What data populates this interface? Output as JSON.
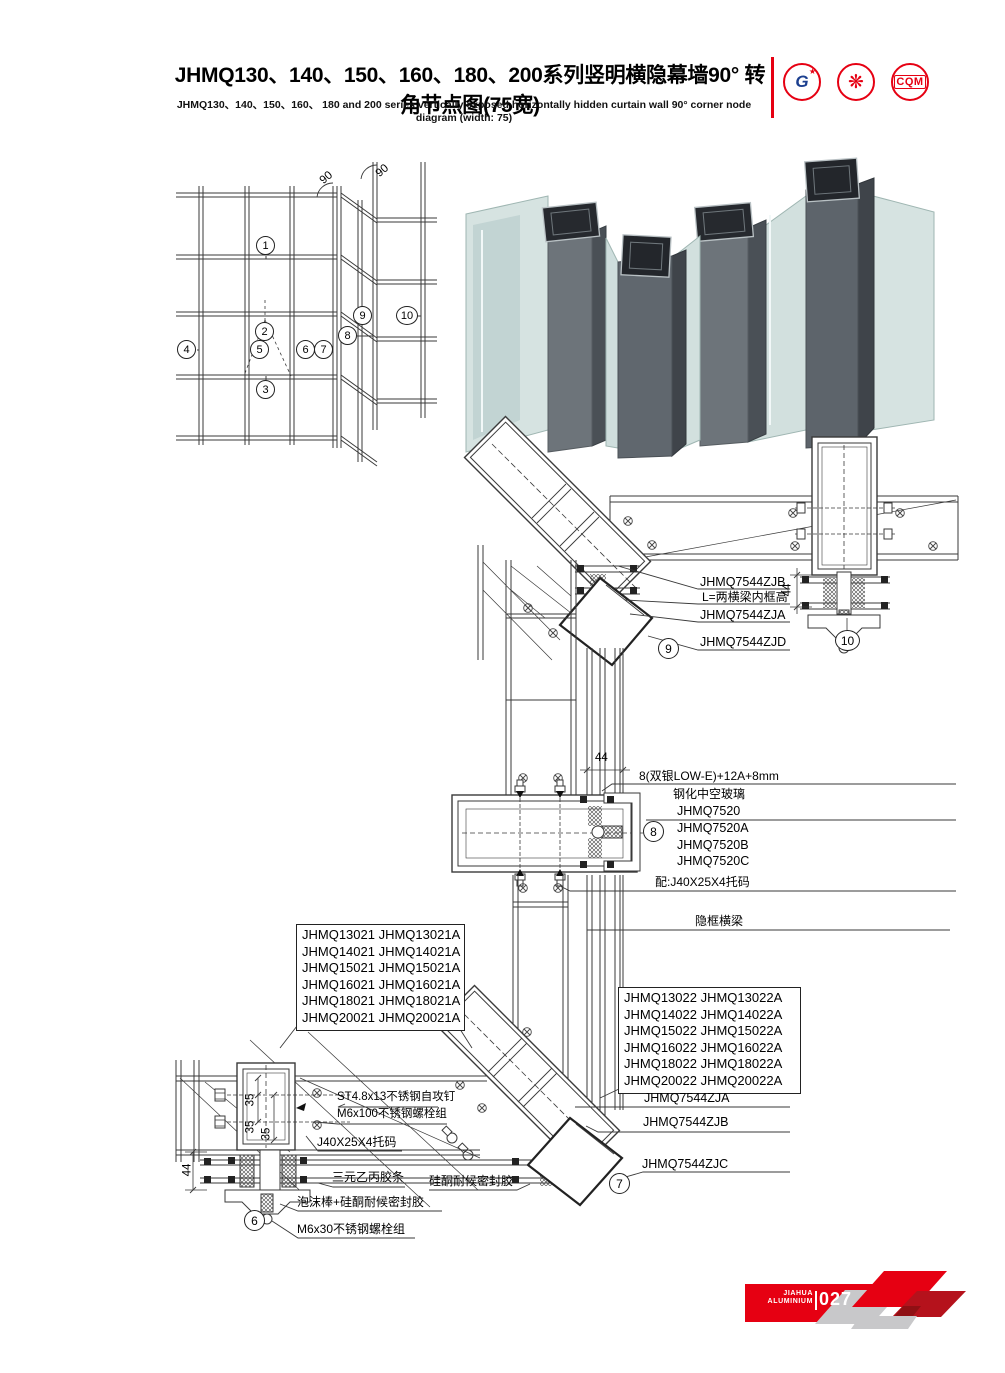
{
  "page": {
    "accent_red": "#e60012",
    "line_color": "#3a3a3a"
  },
  "header": {
    "title_cn": "JHMQ130、140、150、160、180、200系列竖明横隐幕墙90° 转角节点图(75宽)",
    "title_en": "JHMQ130、140、150、160、 180 and 200 series vertically exposed horizontally hidden curtain wall 90°  corner node diagram (width: 75)",
    "logos": {
      "logo1_text": "G",
      "logo1_star": "★",
      "logo2_glyph": "❋",
      "logo3_text": "CQM"
    }
  },
  "elevation": {
    "callouts": [
      "1",
      "2",
      "3",
      "4",
      "5",
      "6",
      "7",
      "8",
      "9",
      "10"
    ],
    "angle_label_1": "90",
    "angle_label_2": "90"
  },
  "details": {
    "top": {
      "zjb": "JHMQ7544ZJB",
      "l_note": "L=两横梁内框高",
      "zja": "JHMQ7544ZJA",
      "zjd": "JHMQ7544ZJD",
      "dim44": "44",
      "c9": "9",
      "c10": "10"
    },
    "mid": {
      "dim44": "44",
      "glass_spec": "8(双银LOW-E)+12A+8mm",
      "glass_type": "钢化中空玻璃",
      "p1": "JHMQ7520",
      "p2": "JHMQ7520A",
      "p3": "JHMQ7520B",
      "p4": "JHMQ7520C",
      "bracket": "配:J40X25X4托码",
      "hidden_beam": "隐框横梁",
      "c8": "8"
    },
    "left_block": [
      "JHMQ13021 JHMQ13021A",
      "JHMQ14021 JHMQ14021A",
      "JHMQ15021 JHMQ15021A",
      "JHMQ16021 JHMQ16021A",
      "JHMQ18021 JHMQ18021A",
      "JHMQ20021 JHMQ20021A"
    ],
    "right_block": [
      "JHMQ13022 JHMQ13022A",
      "JHMQ14022 JHMQ14022A",
      "JHMQ15022 JHMQ15022A",
      "JHMQ16022 JHMQ16022A",
      "JHMQ18022 JHMQ18022A",
      "JHMQ20022 JHMQ20022A"
    ],
    "corner7": {
      "zja": "JHMQ7544ZJA",
      "zjb": "JHMQ7544ZJB",
      "zjc": "JHMQ7544ZJC",
      "c7": "7"
    },
    "bottom": {
      "screw": "ST4.8x13不锈钢自攻钉",
      "bolt100": "M6x100不锈钢螺栓组",
      "bracket": "J40X25X4托码",
      "gasket": "三元乙丙胶条",
      "sealant": "硅酮耐候密封胶",
      "foam": "泡沫棒+硅酮耐候密封胶",
      "bolt30": "M6x30不锈钢螺栓组",
      "dim44": "44",
      "dim35a": "35",
      "dim35b": "35",
      "dim35c": "35",
      "c6": "6"
    }
  },
  "footer": {
    "brand_line1": "JIAHUA",
    "brand_line2": "ALUMINIUM",
    "page_number": "027"
  }
}
